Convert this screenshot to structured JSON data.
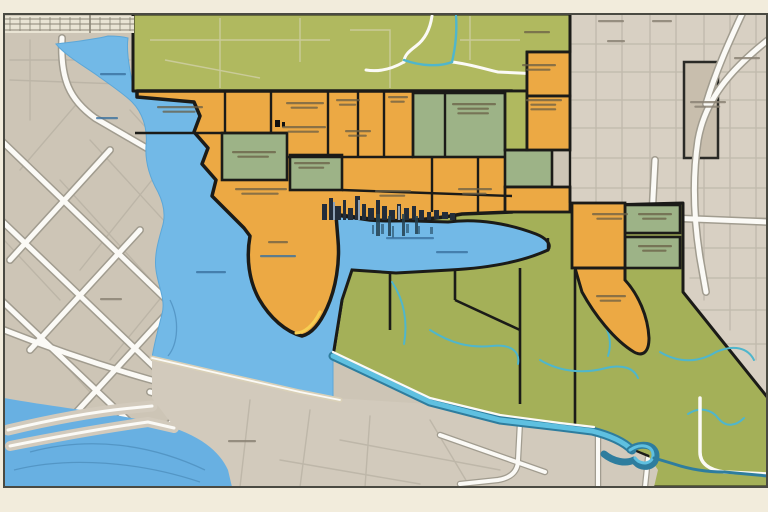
{
  "meta": {
    "title": "Stylized city zoning map illustration",
    "description": "Flat illustrated map: western street grid with river and lake, central orange/green zoning patchwork bounded in black, harbor bay with downtown skyline silhouette, olive rural district with creeks to the southeast, beige street grid to the east, river with oxbow along the bottom.",
    "visible_text_note": "All map labels are illegible smudged micro-text; rendered as smudge marks, no legible words exist in the image."
  },
  "colors": {
    "frame": "#f2ecdc",
    "map-border": "#4a4a42",
    "beige-left": "#cdc5b6",
    "beige-wedge": "#d2cabc",
    "beige-right": "#d8d0c3",
    "block-dark": "#c8bead",
    "road-white": "#fbfaf6",
    "road-casing": "#a19c8f",
    "grid-minor": "#b9b2a4",
    "water": "#72b9e7",
    "water-deep": "#68b0e2",
    "water-line": "#4f90bf",
    "olive-top": "#b0b95f",
    "olive-br": "#a4b058",
    "olive-road": "#cdcda0",
    "sage": "#9db387",
    "orange": "#eca944",
    "zone-border": "#1b1b18",
    "teal-creek": "#4fb6cc",
    "canal-dark": "#2e7d9e",
    "canal-light": "#5fc0e0",
    "skyline": "#232d3a",
    "skyline-light": "#8ea2b6",
    "skyline-shadow": "#24404f",
    "reflection": "#35627f",
    "shore-gold": "#f7cf52",
    "sand": "#d9d0b8",
    "rail-band": "#e9e4d4",
    "rail-line": "#8a8476",
    "smudge": "#6a5f46",
    "smudge-water": "#39719f",
    "smudge-street": "#8b8274"
  },
  "districts": {
    "zoned_city": {
      "fill": "orange",
      "border": "black",
      "cells_orange": 14,
      "cells_sage": 7
    },
    "rural_north": {
      "fill": "olive-top"
    },
    "rural_southeast": {
      "fill": "olive-br",
      "features": [
        "creeks",
        "river-oxbow"
      ]
    },
    "street_grid_west": {
      "fill": "beige-left",
      "features": [
        "diagonal-roads",
        "rail-band",
        "causeways"
      ]
    },
    "street_grid_east": {
      "fill": "beige-right",
      "features": [
        "grid-roads",
        "curved-avenue",
        "dark-block"
      ]
    },
    "water_bodies": [
      "north-river",
      "west-lake",
      "harbor-bay",
      "south-sea",
      "bottom-river"
    ]
  },
  "labels": {
    "zone": [
      {
        "x": 157,
        "y": 106,
        "w": 46,
        "l": 2
      },
      {
        "x": 282,
        "y": 126,
        "w": 44,
        "l": 2
      },
      {
        "x": 345,
        "y": 130,
        "w": 26,
        "l": 2
      },
      {
        "x": 286,
        "y": 102,
        "w": 38,
        "l": 2
      },
      {
        "x": 336,
        "y": 99,
        "w": 24,
        "l": 2
      },
      {
        "x": 388,
        "y": 96,
        "w": 20,
        "l": 2
      },
      {
        "x": 452,
        "y": 103,
        "w": 44,
        "l": 3
      },
      {
        "x": 232,
        "y": 151,
        "w": 44,
        "l": 2
      },
      {
        "x": 294,
        "y": 162,
        "w": 36,
        "l": 2
      },
      {
        "x": 235,
        "y": 188,
        "w": 52,
        "l": 2
      },
      {
        "x": 375,
        "y": 190,
        "w": 36,
        "l": 2
      },
      {
        "x": 458,
        "y": 188,
        "w": 34,
        "l": 2
      },
      {
        "x": 526,
        "y": 99,
        "w": 36,
        "l": 3
      },
      {
        "x": 522,
        "y": 64,
        "w": 34,
        "l": 2
      },
      {
        "x": 524,
        "y": 31,
        "w": 26,
        "l": 1
      },
      {
        "x": 592,
        "y": 213,
        "w": 36,
        "l": 2
      },
      {
        "x": 638,
        "y": 213,
        "w": 34,
        "l": 2
      },
      {
        "x": 638,
        "y": 245,
        "w": 34,
        "l": 2
      },
      {
        "x": 596,
        "y": 295,
        "w": 30,
        "l": 2
      },
      {
        "x": 268,
        "y": 241,
        "w": 20,
        "l": 1
      }
    ],
    "street": [
      {
        "x": 690,
        "y": 101,
        "w": 36,
        "l": 2
      },
      {
        "x": 734,
        "y": 57,
        "w": 26,
        "l": 1
      },
      {
        "x": 598,
        "y": 20,
        "w": 26,
        "l": 1
      },
      {
        "x": 652,
        "y": 20,
        "w": 20,
        "l": 1
      },
      {
        "x": 607,
        "y": 40,
        "w": 18,
        "l": 1
      },
      {
        "x": 228,
        "y": 440,
        "w": 28,
        "l": 1
      },
      {
        "x": 100,
        "y": 298,
        "w": 22,
        "l": 1
      }
    ],
    "water": [
      {
        "x": 100,
        "y": 73,
        "w": 26,
        "l": 1
      },
      {
        "x": 96,
        "y": 117,
        "w": 22,
        "l": 1
      },
      {
        "x": 196,
        "y": 271,
        "w": 30,
        "l": 1
      },
      {
        "x": 260,
        "y": 255,
        "w": 36,
        "l": 1
      },
      {
        "x": 386,
        "y": 237,
        "w": 48,
        "l": 1
      },
      {
        "x": 436,
        "y": 251,
        "w": 32,
        "l": 1
      }
    ]
  }
}
